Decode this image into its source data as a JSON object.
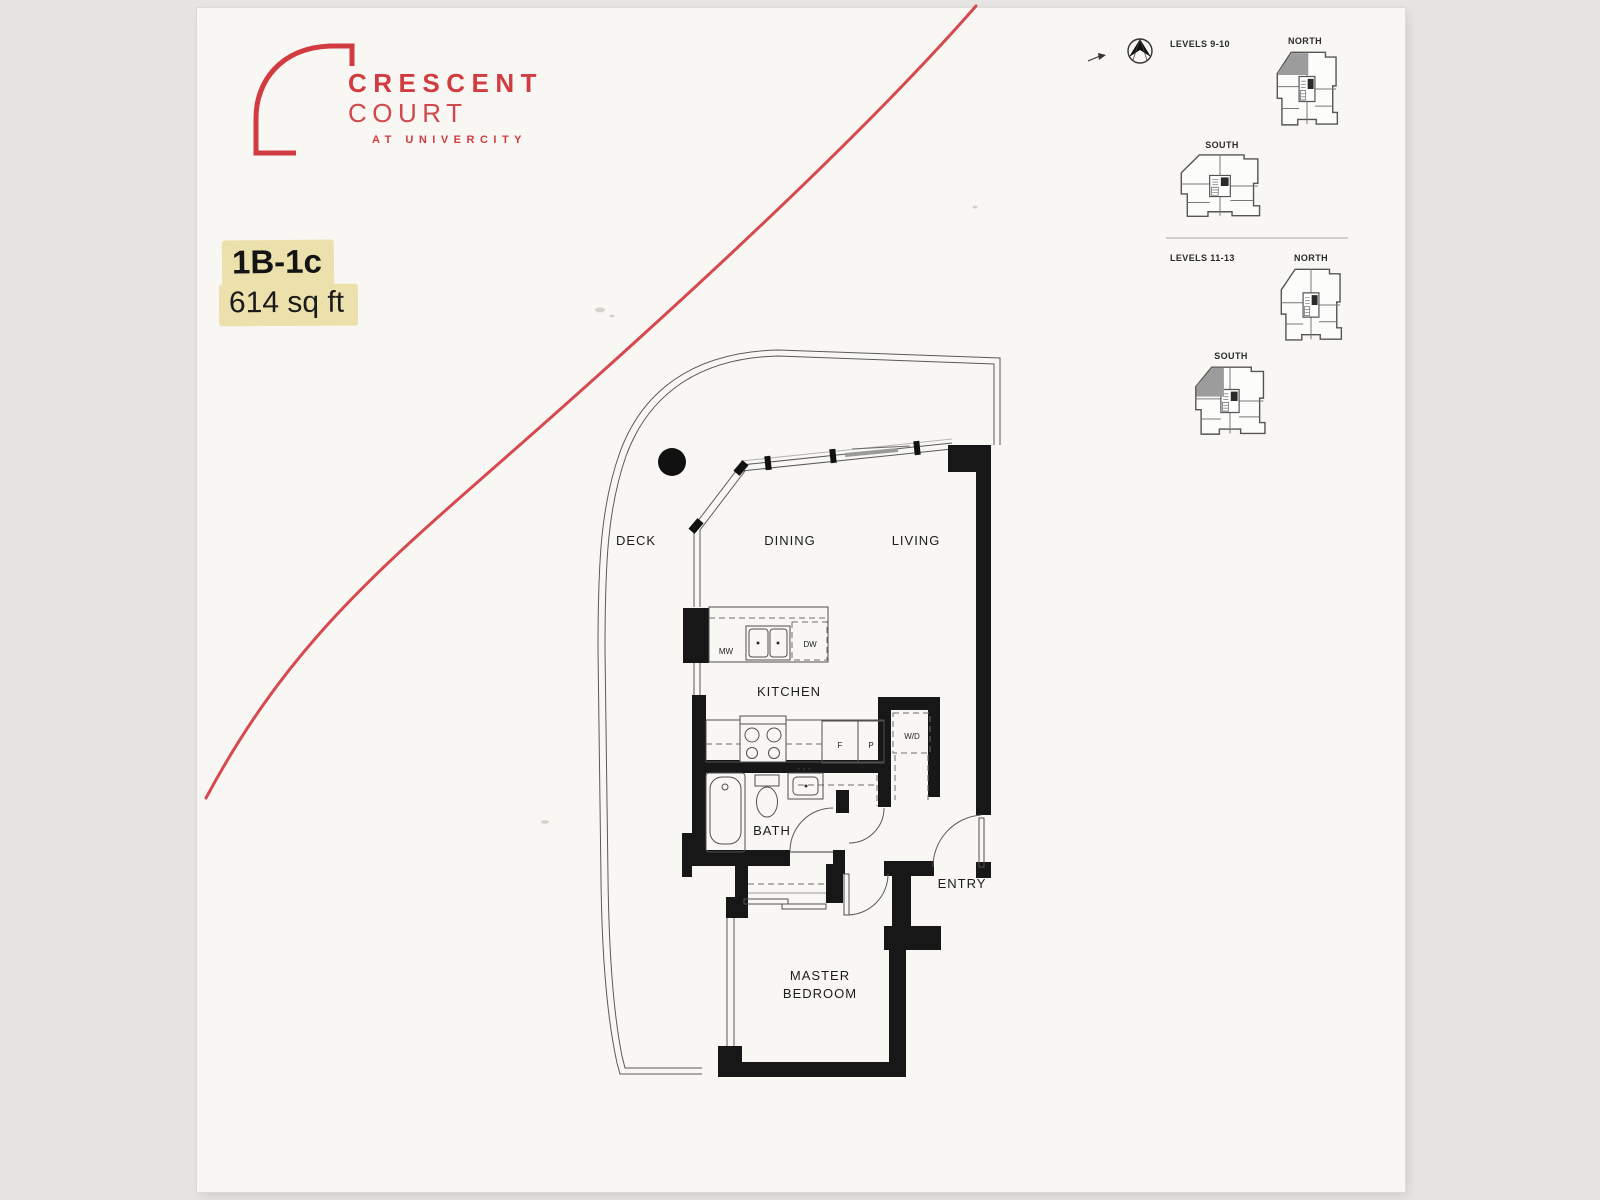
{
  "logo": {
    "brand": "CRESCENT",
    "brand_sub": "COURT",
    "tagline": "AT UNIVERCITY"
  },
  "unit": {
    "code": "1B-1c",
    "area": "614 sq ft"
  },
  "key_plans": {
    "group1": {
      "level": "LEVELS 9-10",
      "north": "NORTH",
      "south": "SOUTH",
      "north_unit_highlighted": true,
      "south_unit_highlighted": false
    },
    "group2": {
      "level": "LEVELS 11-13",
      "north": "NORTH",
      "south": "SOUTH",
      "north_unit_highlighted": false,
      "south_unit_highlighted": true
    }
  },
  "rooms": {
    "deck": "DECK",
    "dining": "DINING",
    "living": "LIVING",
    "kitchen": "KITCHEN",
    "bath": "BATH",
    "entry": "ENTRY",
    "master_line1": "MASTER",
    "master_line2": "BEDROOM"
  },
  "fixtures": {
    "mw": "MW",
    "dw": "DW",
    "f": "F",
    "p": "P",
    "wd": "W/D"
  },
  "colors": {
    "accent_red": "#d23b40",
    "highlight": "#ece1ad",
    "wall": "#171717",
    "key_plan_unit_fill": "#9c9c9c"
  }
}
